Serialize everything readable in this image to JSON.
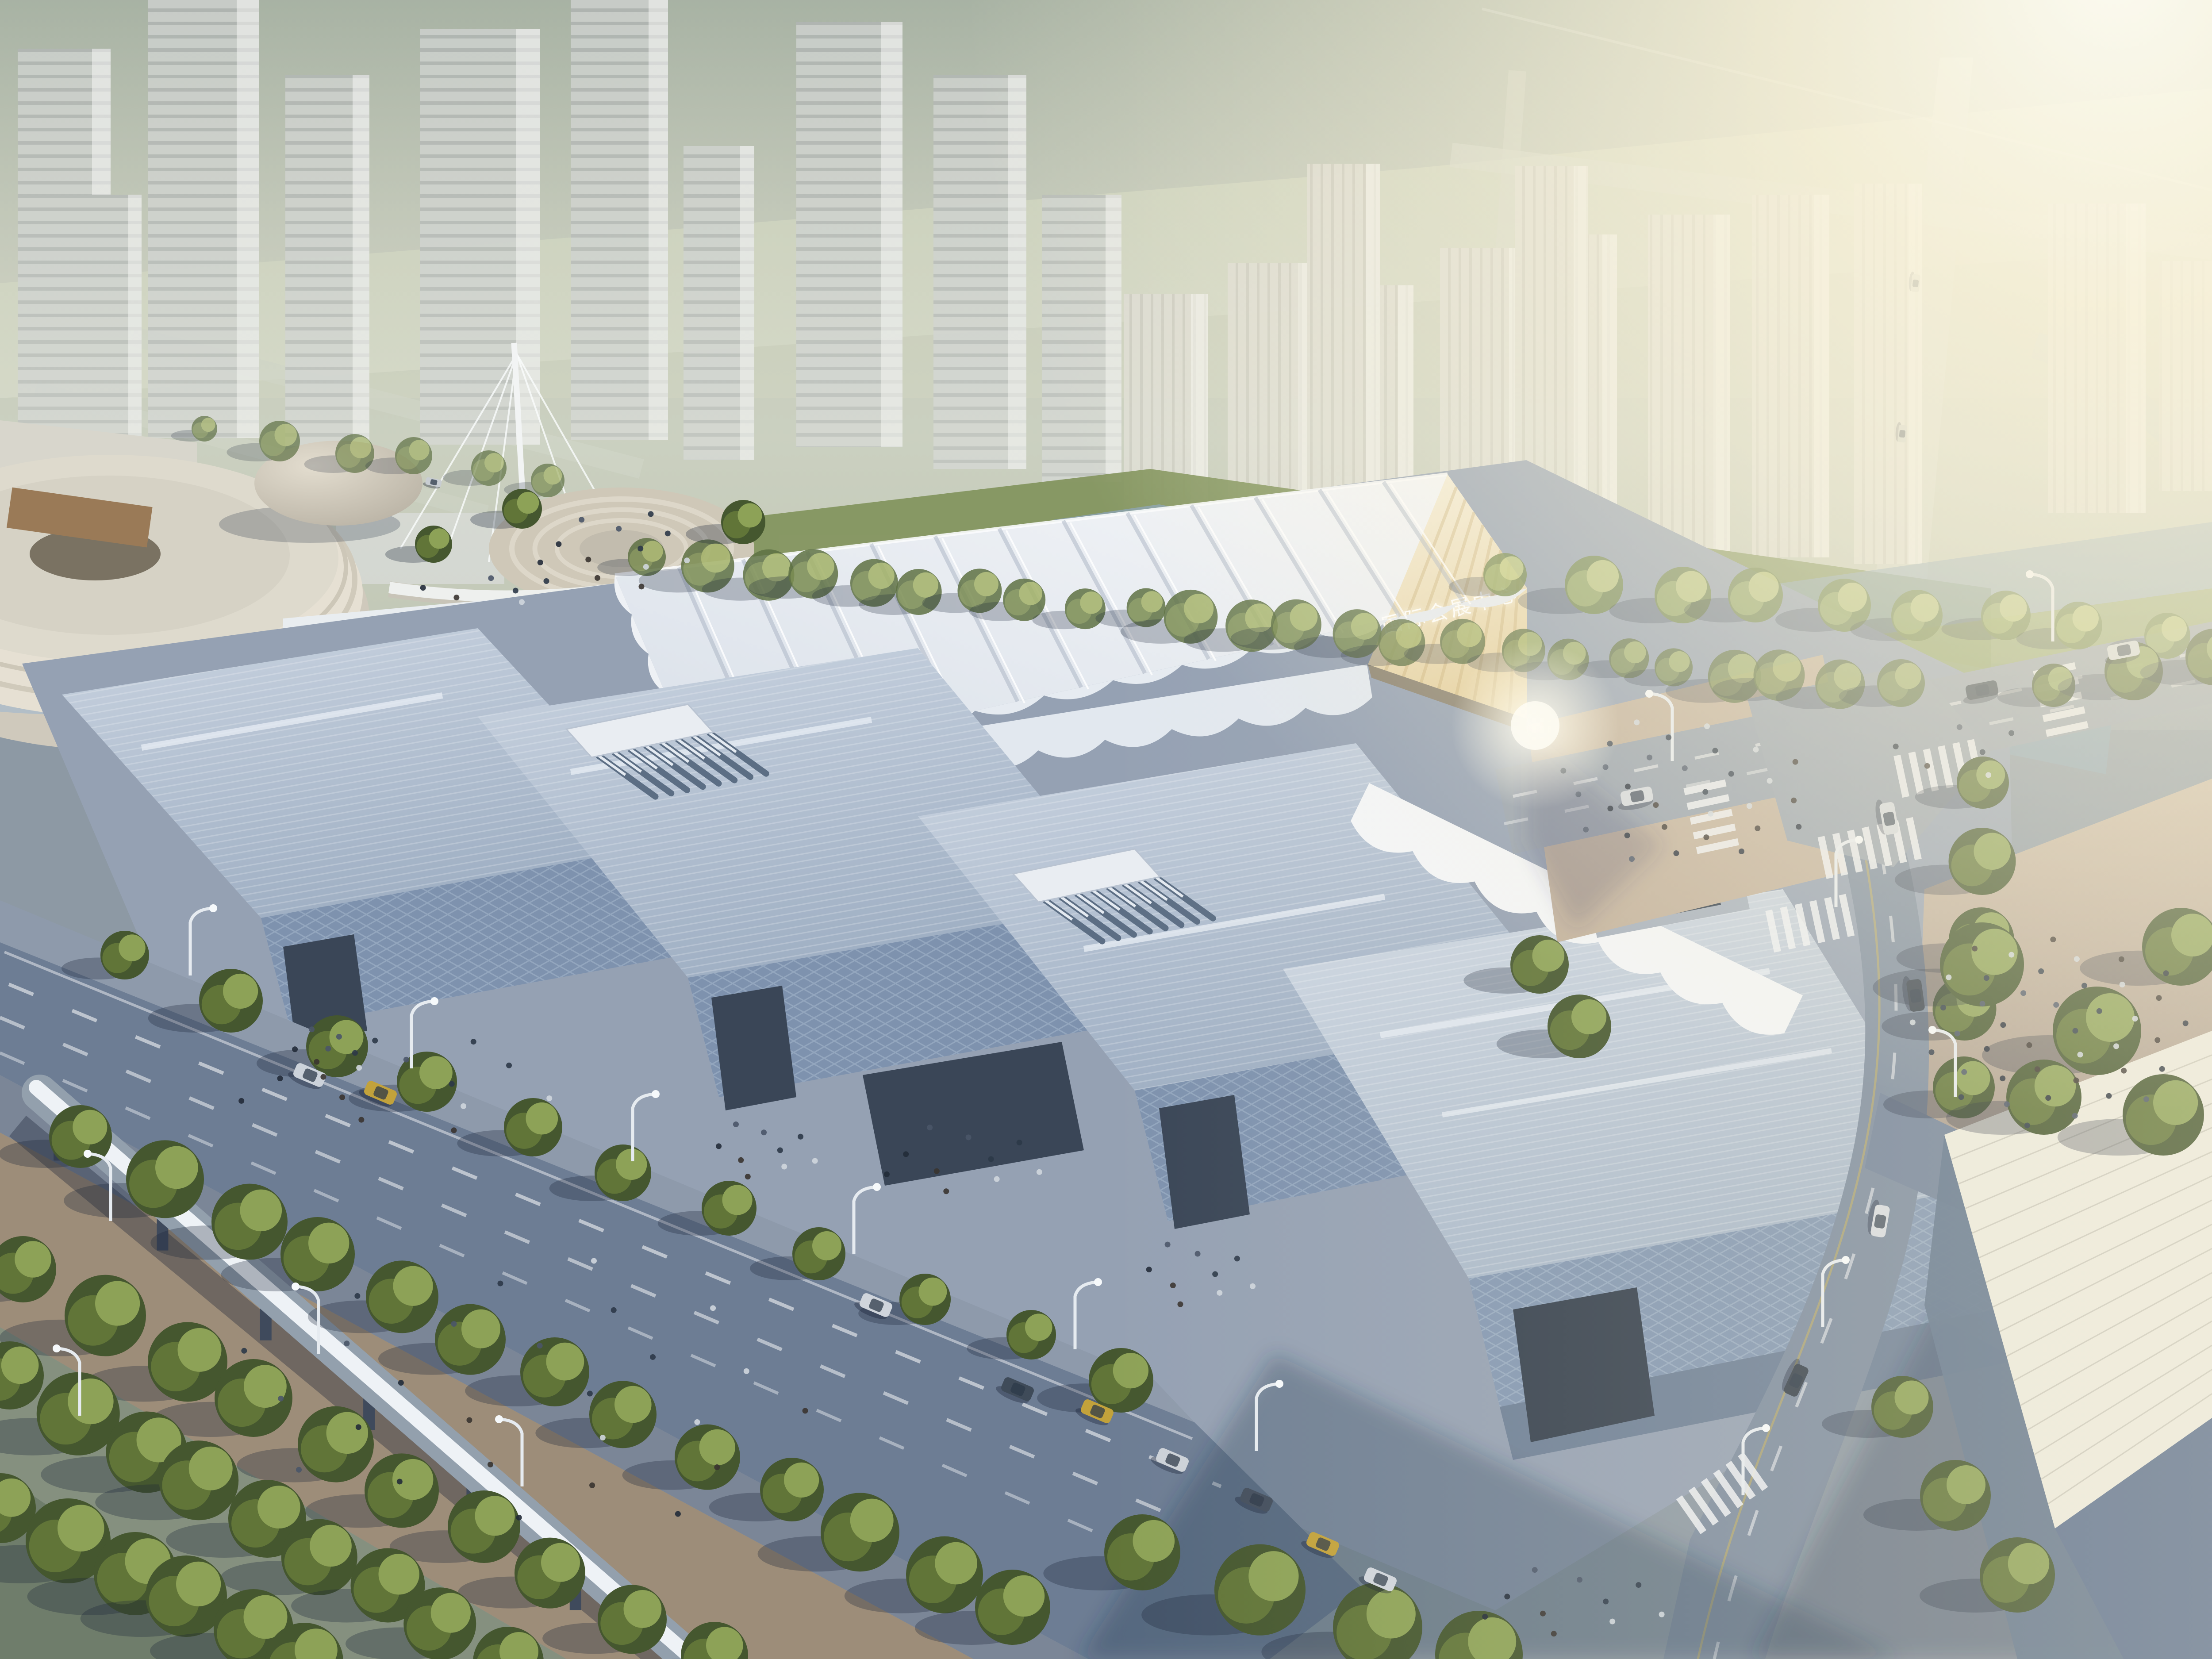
{
  "scene": {
    "description": "Aerial architectural rendering of a riverside international convention and exhibition center complex at hazy sunrise, with sawtooth exhibition halls, a white pleated tent-roof hall, tree-lined boulevards, an elevated monorail beam and a city skyline in haze",
    "facade_sign": "国际会展中心",
    "palette": {
      "sky_top": "#a4afa0",
      "sky_low": "#d2d3c2",
      "sun_glow": "#fdf6dd",
      "hall_roof": "#b6c3d4",
      "hall_wall_shadow": "#7e92ae",
      "tent_roof": "#f1f3f6",
      "sunlit_wall": "#ecdcae",
      "road_shadow": "#6d7d94",
      "road_lit": "#97a1ad",
      "plaza_sunlit": "#c2b19c",
      "foliage": "#617538",
      "water": "#8ba3b3",
      "monorail": "#eef2f6"
    }
  }
}
